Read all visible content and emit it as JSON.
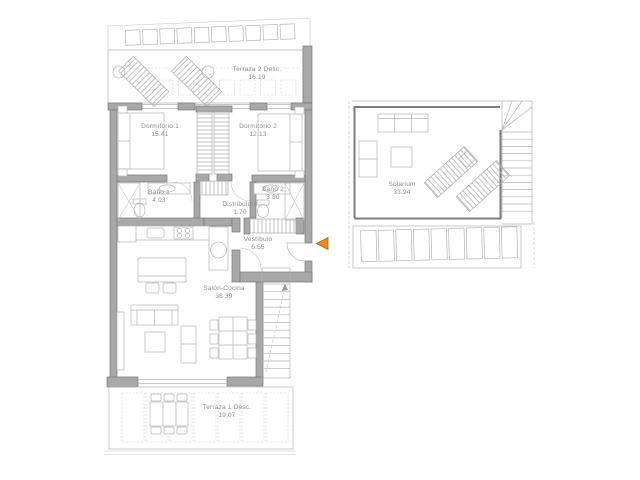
{
  "plan": {
    "type": "apartment-floor-plan",
    "rooms": [
      {
        "name": "Terraza 2 Desc.",
        "area": "16.19"
      },
      {
        "name": "Dormitorio 1",
        "area": "15.41"
      },
      {
        "name": "Dormitorio 2",
        "area": "12.13"
      },
      {
        "name": "Baño 1",
        "area": "4.03"
      },
      {
        "name": "Baño 2",
        "area": "3.80"
      },
      {
        "name": "Distribuidor",
        "area": "1.70"
      },
      {
        "name": "Vestíbulo",
        "area": "6.55"
      },
      {
        "name": "Salón-Cocina",
        "area": "36.39"
      },
      {
        "name": "Terraza 1 Desc.",
        "area": "19.07"
      },
      {
        "name": "Solarium",
        "area": "33.94"
      }
    ],
    "entrance": {
      "marker": "arrow",
      "direction": "left"
    },
    "colors": {
      "accent": "#ec8c1f",
      "accent_stroke": "#b36200",
      "wall": "#a8a8a8",
      "text": "#8d8d8d"
    }
  }
}
